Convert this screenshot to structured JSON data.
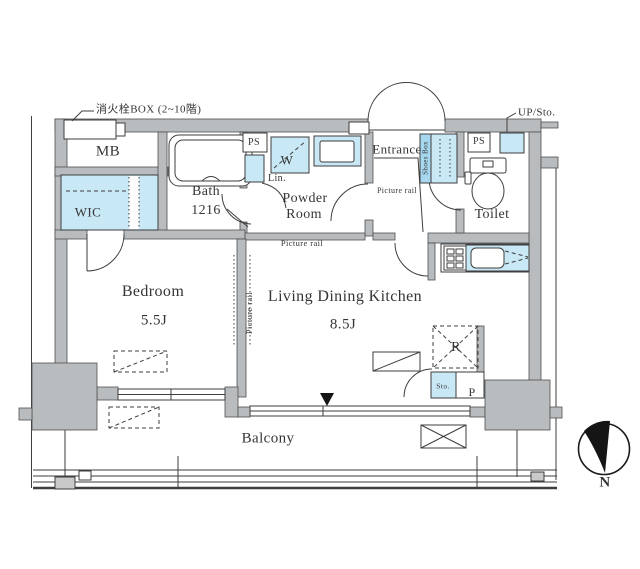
{
  "plan": {
    "annotations": {
      "fire_hydrant": "消火栓BOX (2~10階)",
      "up_sto": "UP/Sto."
    },
    "rooms": {
      "mb": "MB",
      "wic": "WIC",
      "bath": {
        "name": "Bath",
        "size": "1216"
      },
      "powder": {
        "line1": "Powder",
        "line2": "Room"
      },
      "entrance": "Entrance",
      "toilet": "Toilet",
      "bedroom": {
        "name": "Bedroom",
        "size": "5.5J"
      },
      "ldk": {
        "name": "Living Dining Kitchen",
        "size": "8.5J"
      },
      "balcony": "Balcony"
    },
    "fixtures": {
      "ps": "PS",
      "lin": "Lin.",
      "washer": "W",
      "shoes_box": "Shoes Box",
      "fridge": "R",
      "storage": "Sto.",
      "pipe": "P"
    },
    "picture_rail": "Picture rail",
    "compass_north": "N",
    "colors": {
      "wall": "#b8bcbe",
      "wall_edge": "#4f4f4f",
      "line": "#3e3e3e",
      "blue": "#c9e8f6",
      "blue_dark": "#a6d7ee",
      "text": "#353535",
      "drain": "#c9c9c9"
    }
  }
}
